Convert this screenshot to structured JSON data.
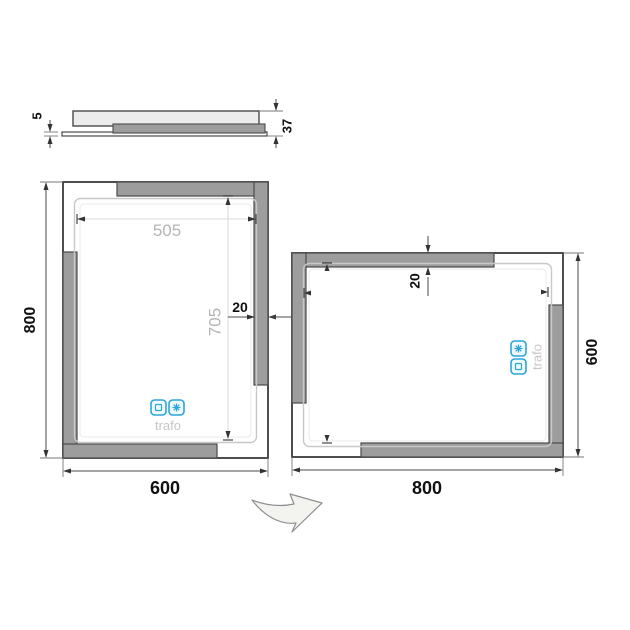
{
  "side_view": {
    "glass_thickness": "5",
    "depth": "37"
  },
  "portrait_mirror": {
    "width": "600",
    "height": "800",
    "led_width": "505",
    "led_height": "705",
    "frame_strip": "20",
    "trafo": "trafo"
  },
  "landscape_mirror": {
    "width": "800",
    "height": "600",
    "frame_strip": "20",
    "trafo": "trafo"
  },
  "icons": {
    "touch_sensor": "square-icon",
    "heating": "snowflake-icon",
    "rotation": "rotate-arrow-icon"
  },
  "colors": {
    "accent_blue": "#2ba6d9",
    "strip_gray": "#9d9d9d",
    "dim_text_gray": "#b5b5b5",
    "line_dark": "#3a3a3a"
  }
}
